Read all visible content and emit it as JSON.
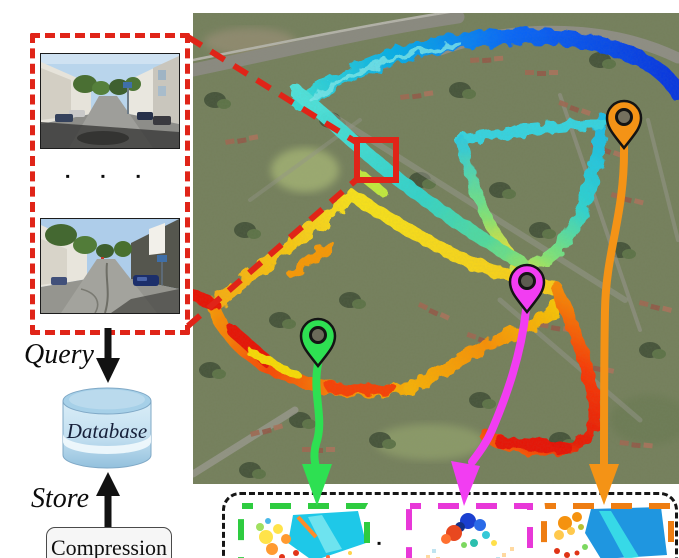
{
  "query_panel": {
    "ellipsis": "▪ ▪ ▪",
    "query_label": "Query",
    "database_label": "Database",
    "store_label": "Store",
    "compression_label": "Compression"
  },
  "map": {
    "marker": {
      "shape": "square",
      "color": "#e51300"
    },
    "pins": [
      {
        "id": "orange",
        "color": "#f49316"
      },
      {
        "id": "magenta",
        "color": "#f23df2"
      },
      {
        "id": "green",
        "color": "#2ee052"
      }
    ],
    "trajectory_palette": [
      "#0030e8",
      "#0066ff",
      "#00b0f0",
      "#35e0dc",
      "#7ce87c",
      "#d2ee4a",
      "#ffe818",
      "#ffae08",
      "#ff5500",
      "#ee1100"
    ]
  },
  "results_panel": {
    "separator_dot": "▪",
    "frames": [
      {
        "id": "green",
        "color": "#2ecc40"
      },
      {
        "id": "magenta",
        "color": "#e838d8"
      },
      {
        "id": "orange",
        "color": "#ee7d12"
      }
    ]
  },
  "colors": {
    "accent_red": "#e02418",
    "arrow_black": "#121212",
    "pin_green": "#2ee052",
    "pin_magenta": "#f23df2",
    "pin_orange": "#f49316",
    "frame_green": "#2ecc40",
    "frame_magenta": "#e838d8",
    "frame_orange": "#ee7d12",
    "database_blue": "#a6d0e8"
  }
}
